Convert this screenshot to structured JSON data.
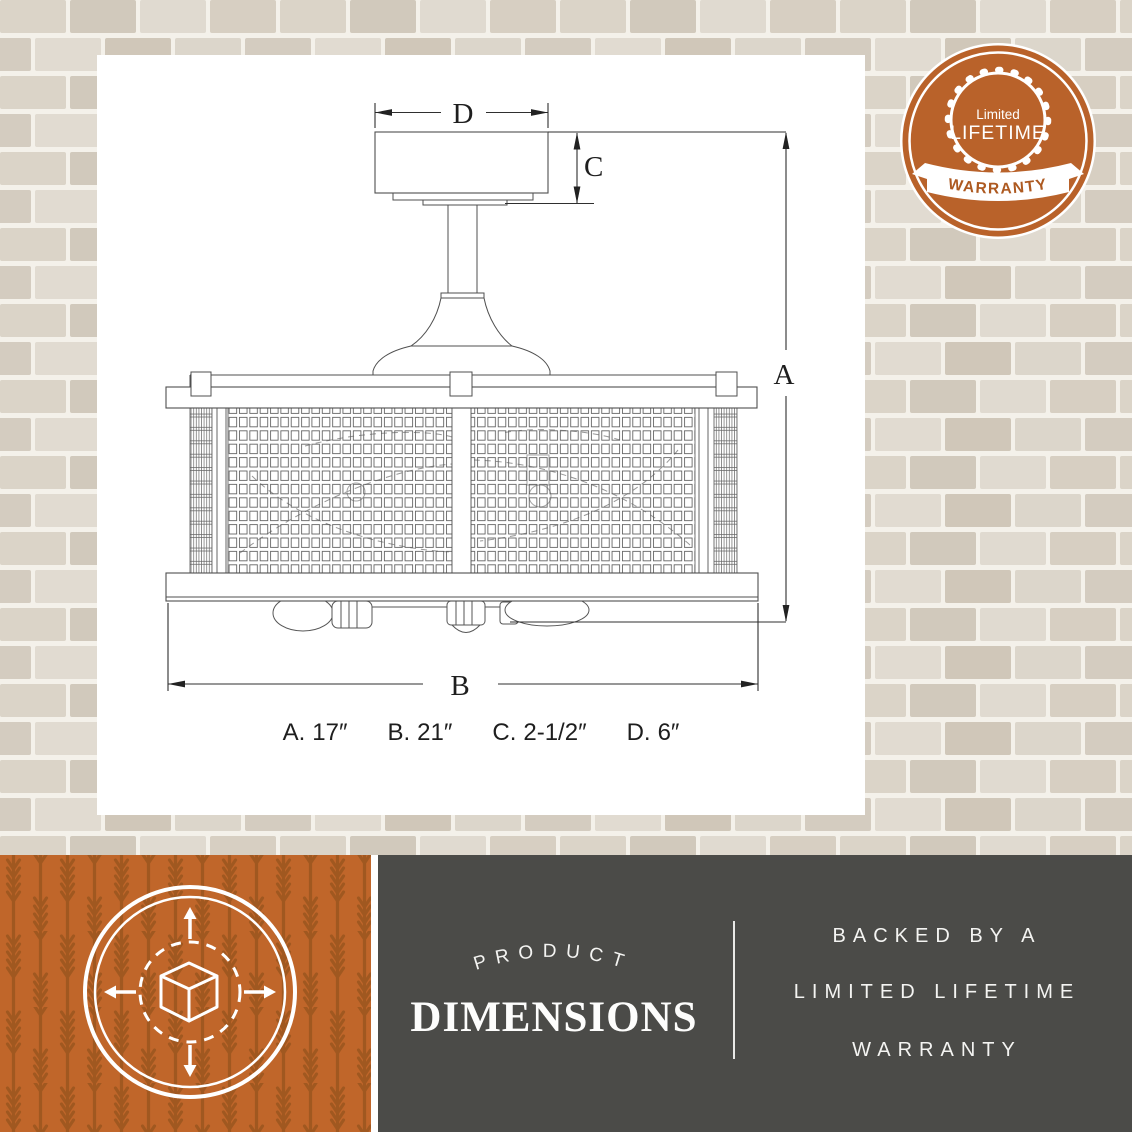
{
  "drawing": {
    "dim_letters": {
      "a": "A",
      "b": "B",
      "c": "C",
      "d": "D"
    }
  },
  "dimensions_row": [
    {
      "label": "A.",
      "value": "17″"
    },
    {
      "label": "B.",
      "value": "21″"
    },
    {
      "label": "C.",
      "value": "2-1/2″"
    },
    {
      "label": "D.",
      "value": "6″"
    }
  ],
  "badge": {
    "top": "Limited",
    "middle": "LIFETIME",
    "banner": "WARRANTY"
  },
  "bottom_bar": {
    "arched_title": "PRODUCT",
    "main_title": "DIMENSIONS",
    "right_lines": [
      "BACKED BY A",
      "LIMITED LIFETIME",
      "WARRANTY"
    ]
  },
  "colors": {
    "accent_orange": "#b9622a",
    "pattern_orange_dark": "#a05820",
    "panel_gray": "#4b4b48",
    "mortar_white": "#f4f1ea",
    "line_gray": "#4f4f4f"
  }
}
